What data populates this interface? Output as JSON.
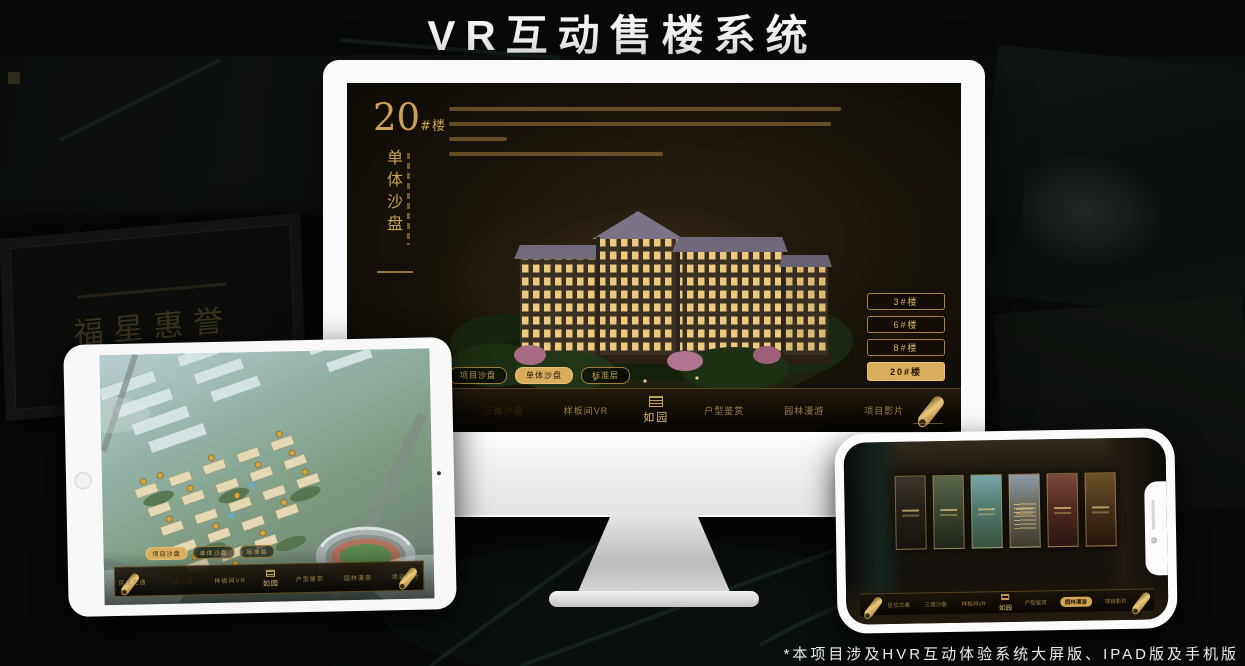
{
  "title": "VR互动售楼系统",
  "footnote": "*本项目涉及HVR互动体验系统大屏版、IPAD版及手机版",
  "background": {
    "plaque_text": "福星惠誉"
  },
  "mode_tabs": [
    "项目沙盘",
    "单体沙盘",
    "标准层"
  ],
  "nav": {
    "items": [
      "区位交通",
      "三维沙盘",
      "样板间VR",
      "户型鉴赏",
      "园林漫游",
      "项目影片"
    ],
    "logo": "如园"
  },
  "monitor": {
    "building_no": "20",
    "building_no_suffix": "#楼",
    "building_subtitle": "单体沙盘",
    "floor_buttons": [
      "3#楼",
      "6#楼",
      "8#楼",
      "20#楼"
    ],
    "active_floor_button": "20#楼",
    "active_mode_tab": "单体沙盘",
    "active_nav_item": "三维沙盘"
  },
  "ipad": {
    "active_mode_tab": "项目沙盘",
    "active_nav_item": "三维沙盘"
  },
  "phone": {
    "active_nav_item": "园林漫游"
  },
  "colors": {
    "gold": "#c9a254",
    "gold_bright": "#e0bc6f",
    "highlight_bg": "#d8ad5c"
  }
}
